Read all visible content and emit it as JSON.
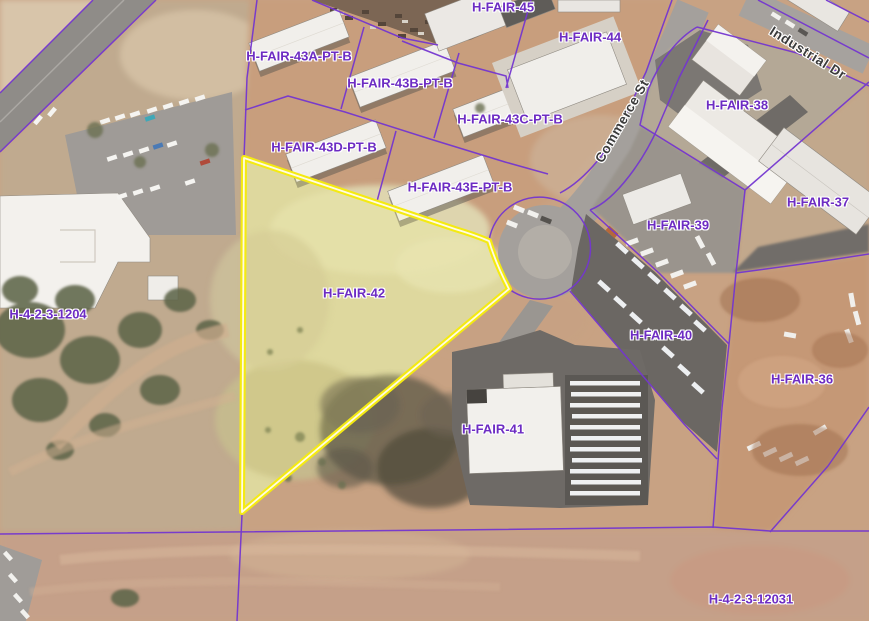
{
  "map": {
    "selected_parcel": "H-FAIR-42",
    "parcel_labels": [
      {
        "id": "h-fair-45",
        "label": "H-FAIR-45"
      },
      {
        "id": "h-fair-44",
        "label": "H-FAIR-44"
      },
      {
        "id": "h-fair-43a-pt-b",
        "label": "H-FAIR-43A-PT-B"
      },
      {
        "id": "h-fair-43b-pt-b",
        "label": "H-FAIR-43B-PT-B"
      },
      {
        "id": "h-fair-43c-pt-b",
        "label": "H-FAIR-43C-PT-B"
      },
      {
        "id": "h-fair-43d-pt-b",
        "label": "H-FAIR-43D-PT-B"
      },
      {
        "id": "h-fair-43e-pt-b",
        "label": "H-FAIR-43E-PT-B"
      },
      {
        "id": "h-fair-38",
        "label": "H-FAIR-38"
      },
      {
        "id": "h-fair-37",
        "label": "H-FAIR-37"
      },
      {
        "id": "h-fair-39",
        "label": "H-FAIR-39"
      },
      {
        "id": "h-fair-42",
        "label": "H-FAIR-42"
      },
      {
        "id": "h-fair-40",
        "label": "H-FAIR-40"
      },
      {
        "id": "h-fair-36",
        "label": "H-FAIR-36"
      },
      {
        "id": "h-fair-41",
        "label": "H-FAIR-41"
      },
      {
        "id": "h-4-2-3-1204",
        "label": "H-4-2-3-1204"
      },
      {
        "id": "h-4-2-3-12031",
        "label": "H-4-2-3-12031"
      }
    ],
    "street_labels": [
      {
        "id": "commerce-st",
        "label": "Commerce St"
      },
      {
        "id": "industrial-dr",
        "label": "Industrial Dr"
      }
    ],
    "colors": {
      "parcel_line": "#7436d0",
      "parcel_label_text": "#6d2cc3",
      "street_label_text": "#3b3b3b",
      "selection_outline": "#f4ea12",
      "selection_inner_line": "#fffbe4"
    }
  }
}
